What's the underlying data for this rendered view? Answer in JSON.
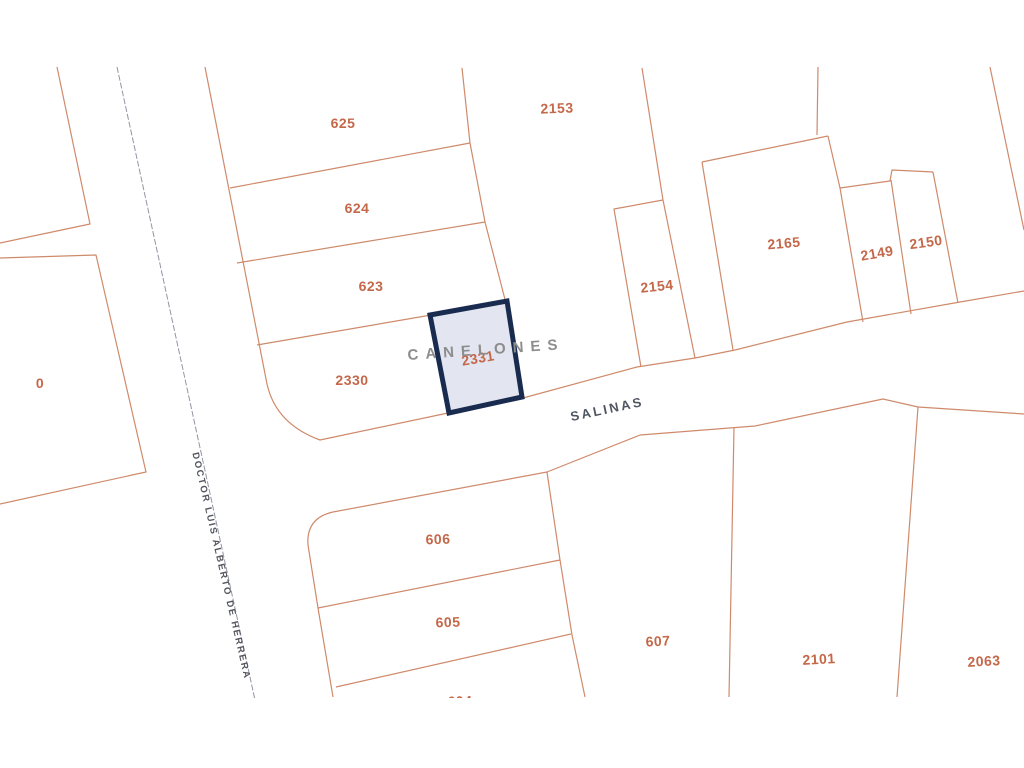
{
  "map": {
    "type": "cadastral-parcel-map",
    "streets": {
      "canelones": "CANELONES",
      "salinas": "SALINAS",
      "herrera": "DOCTOR LUIS ALBERTO DE HERRERA"
    },
    "highlighted_parcel": {
      "label": "2331",
      "fill_color": "#e3e6f0",
      "border_color": "#1a2b50"
    },
    "parcel_labels": {
      "p0": "0",
      "p625": "625",
      "p624": "624",
      "p623": "623",
      "p2330": "2330",
      "p2331": "2331",
      "p2153": "2153",
      "p2154": "2154",
      "p2165": "2165",
      "p2149": "2149",
      "p2150": "2150",
      "p606": "606",
      "p605": "605",
      "p604": "604",
      "p607": "607",
      "p2101": "2101",
      "p2063": "2063"
    },
    "colors": {
      "background": "#ffffff",
      "parcel_line": "#cf8a6b",
      "parcel_label_text": "#c4684a",
      "road_centerline": "#9096a2",
      "street_label_dark": "#4f5662",
      "street_label_gray": "#8d8d8d",
      "highlight_border": "#1a2b50",
      "highlight_fill": "#e3e6f0"
    }
  }
}
